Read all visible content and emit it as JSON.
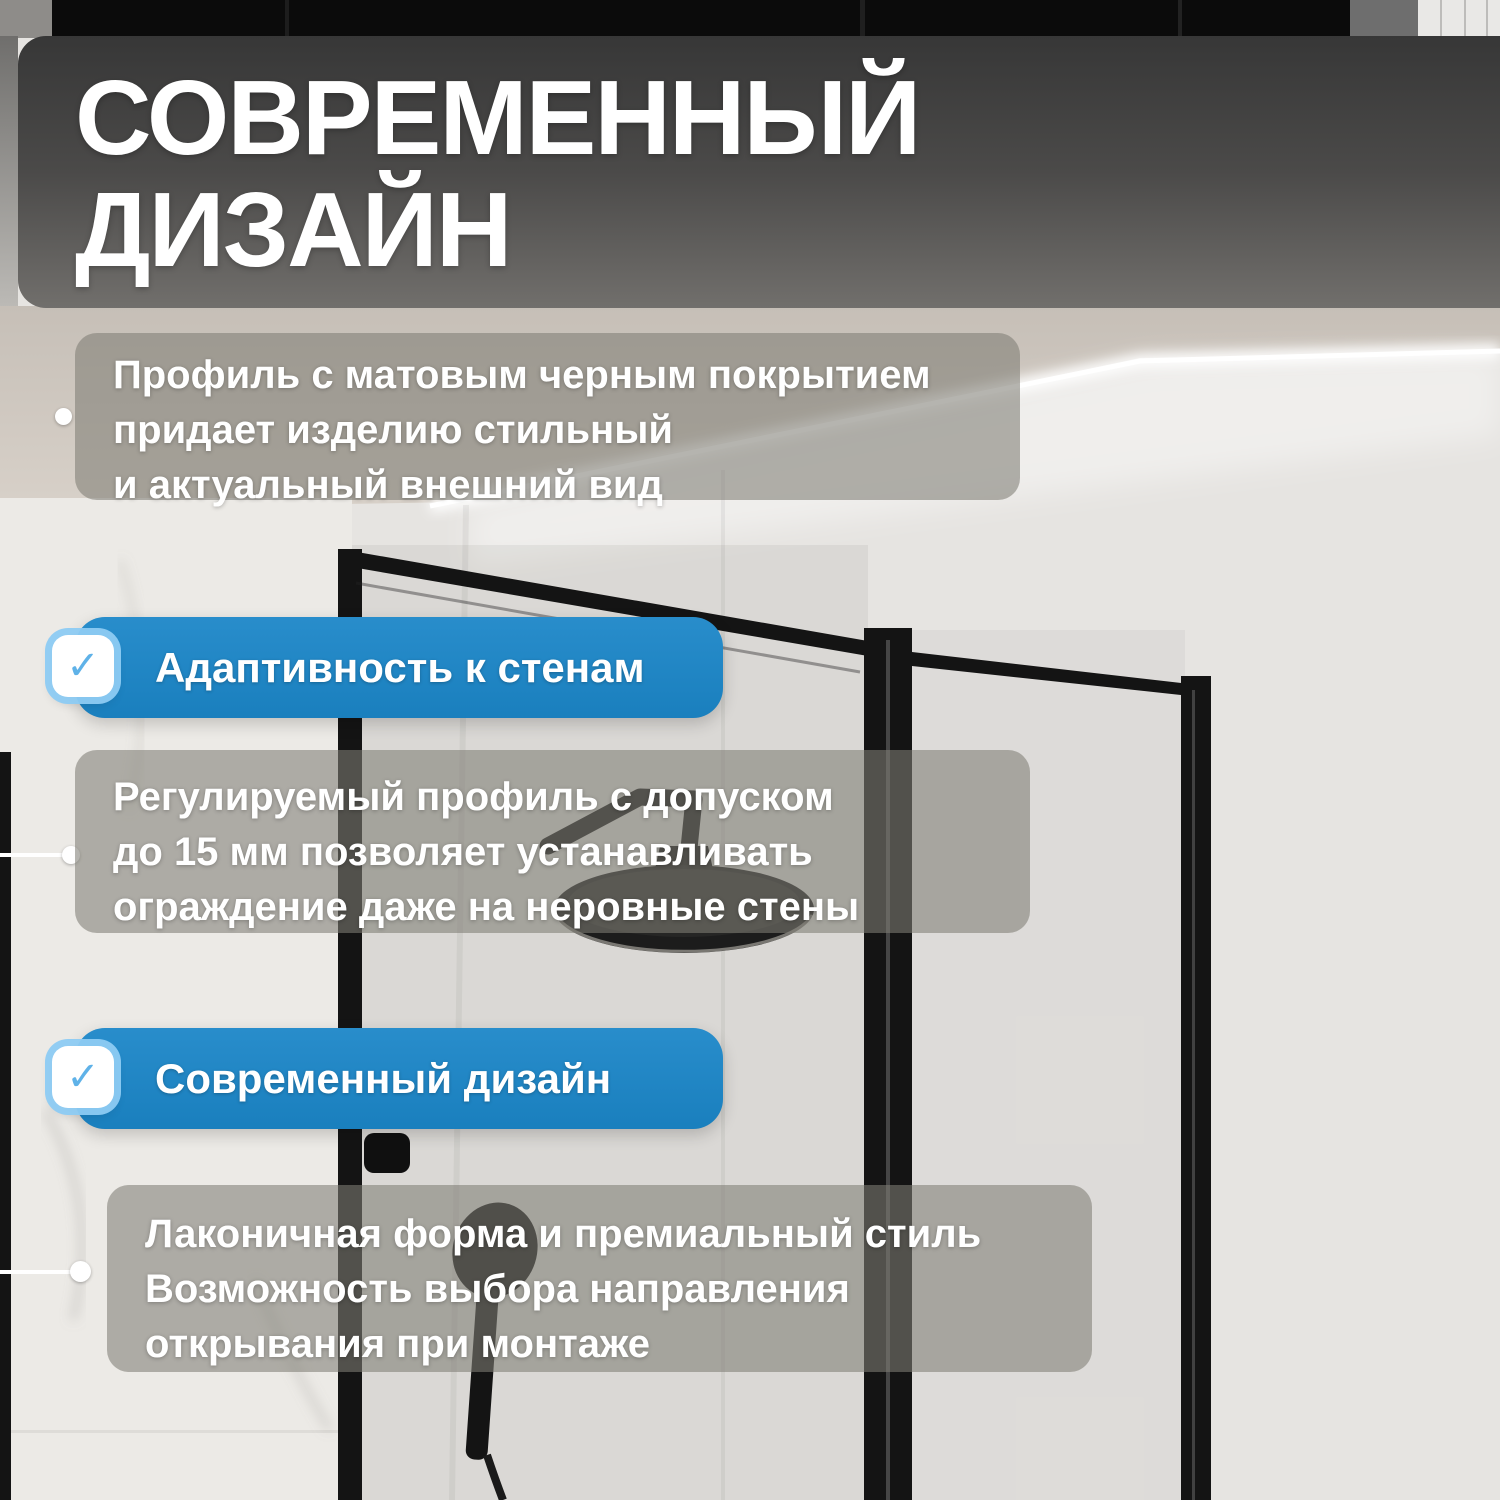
{
  "title": {
    "line1": "СОВРЕМЕННЫЙ",
    "line2": "ДИЗАЙН"
  },
  "intro": {
    "lines": [
      "Профиль с матовым черным покрытием",
      "придает изделию стильный",
      "и актуальный внешний вид"
    ]
  },
  "features": [
    {
      "badge": "Адаптивность к стенам",
      "lines": [
        "Регулируемый профиль с допуском",
        "до 15 мм позволяет устанавливать",
        "ограждение даже на неровные стены"
      ]
    },
    {
      "badge": "Современный дизайн",
      "lines": [
        "Лаконичная форма и премиальный стиль",
        "Возможность выбора направления",
        "открывания при монтаже"
      ]
    }
  ],
  "icons": {
    "check": "✓"
  },
  "colors": {
    "badge_blue": "#1b86c8",
    "check_blue": "#5fb2e8",
    "check_ring": "rgba(141,203,243,0.95)",
    "card_overlay": "rgba(128,125,118,0.58)",
    "title_text": "#ffffff",
    "frame_black": "#141414"
  }
}
